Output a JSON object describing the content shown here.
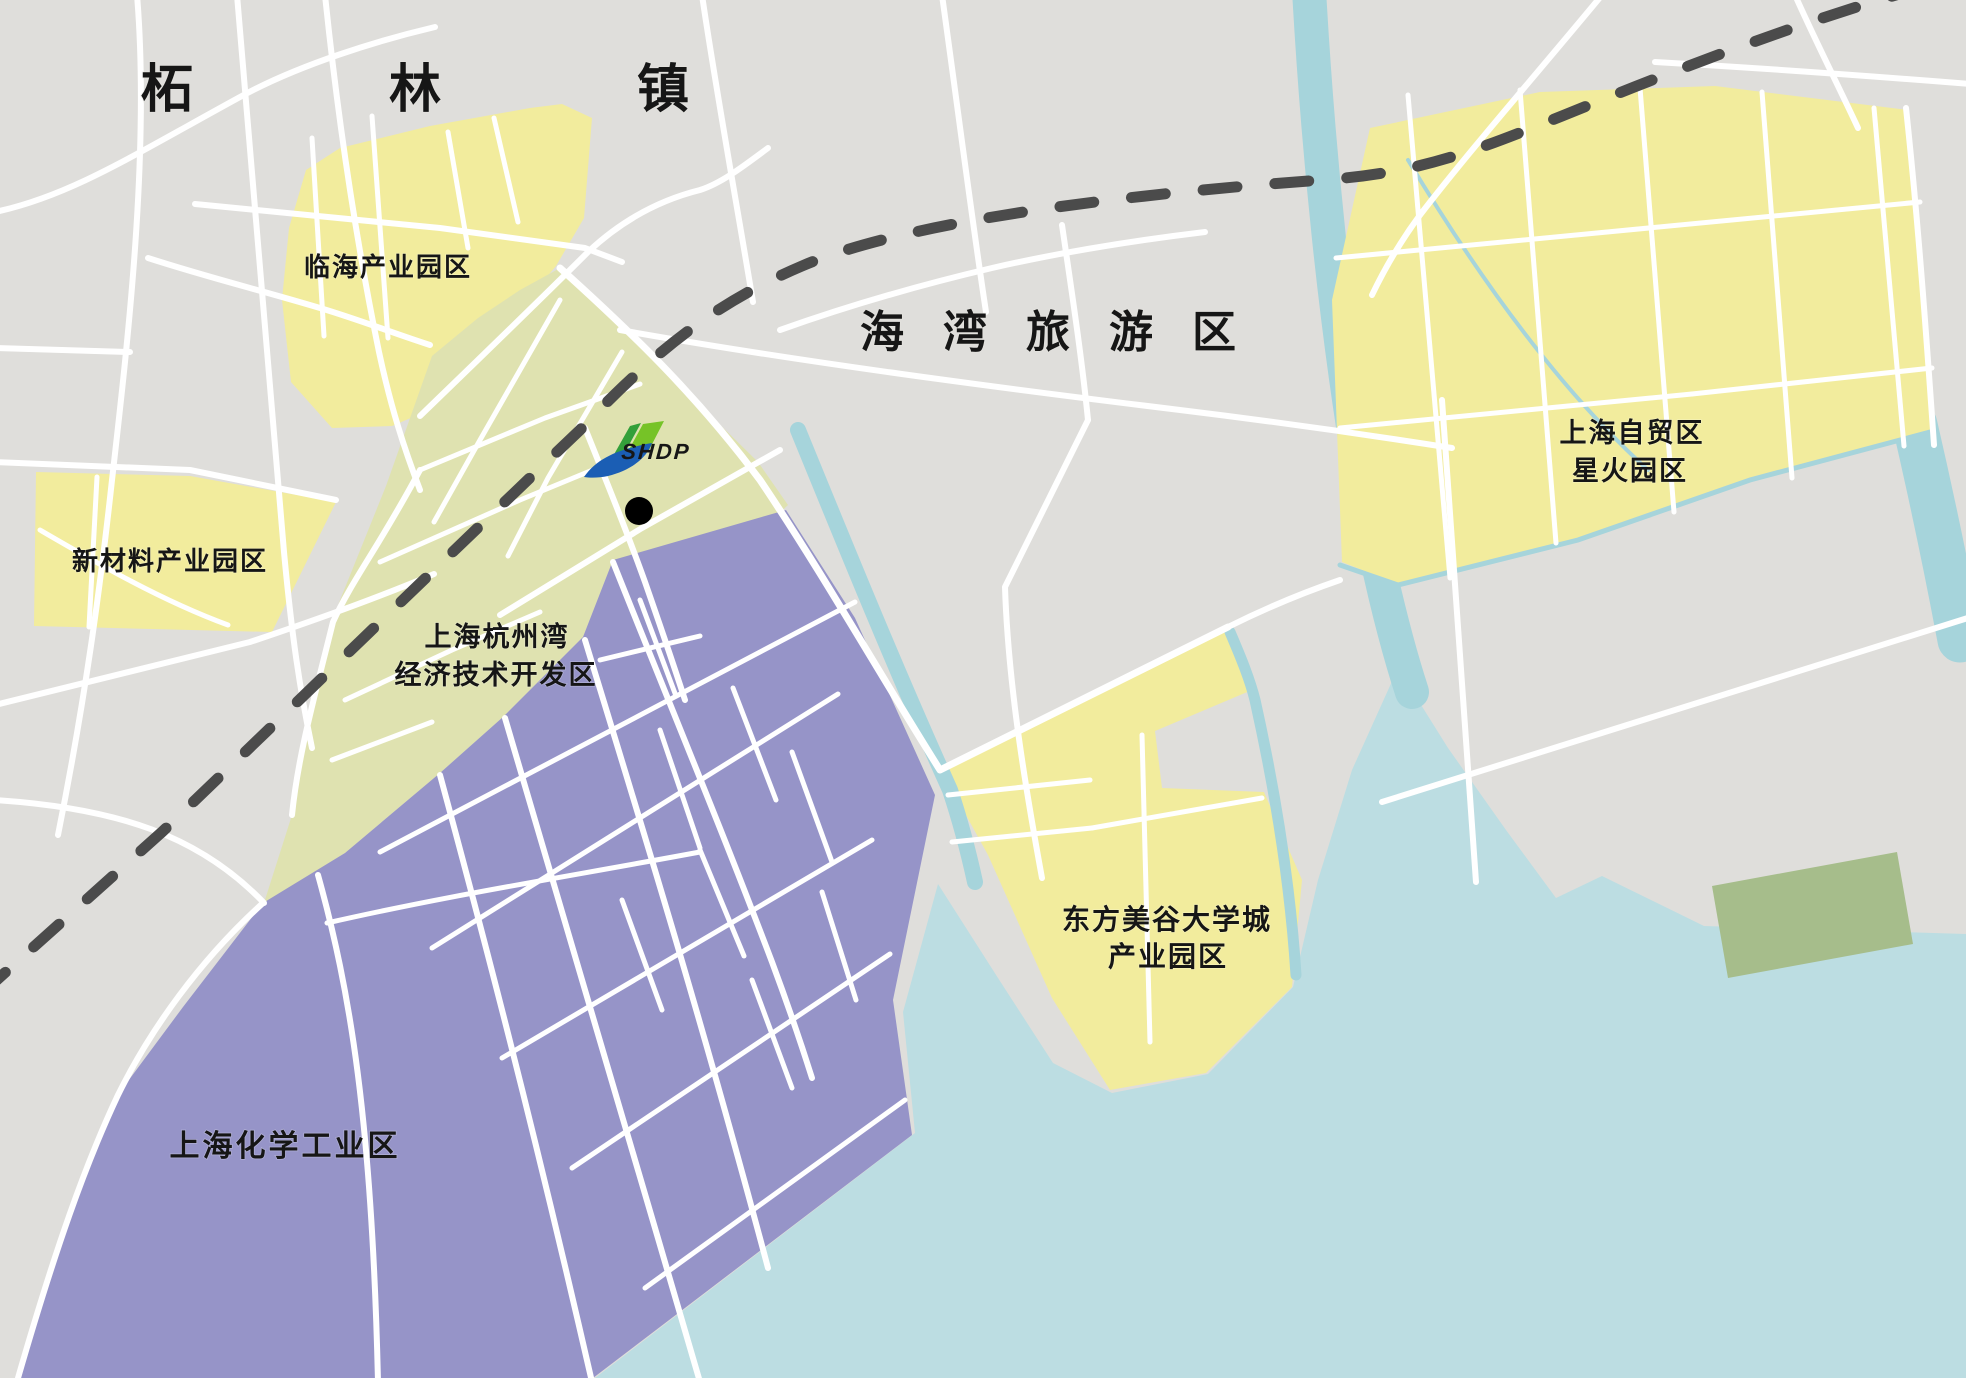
{
  "map": {
    "town_labels": {
      "zhelin": "柘林镇",
      "haiwan": "海湾旅游区"
    },
    "zones": [
      {
        "id": "linhai",
        "name": "临海产业园区"
      },
      {
        "id": "xincailiao",
        "name": "新材料产业园区"
      },
      {
        "id": "kaifaqu",
        "name_line1": "上海杭州湾",
        "name_line2": "经济技术开发区"
      },
      {
        "id": "huagong",
        "name": "上海化学工业区"
      },
      {
        "id": "meigu",
        "name_line1": "东方美谷大学城",
        "name_line2": "产业园区"
      },
      {
        "id": "zimao",
        "name_line1": "上海自贸区",
        "name_line2": "星火园区"
      }
    ],
    "marker": {
      "logo_text": "SHDP"
    },
    "colors": {
      "base": "#dfdedb",
      "road": "#ffffff",
      "water": "#bcdde2",
      "canal": "#a6d4db",
      "railway": "#4b4b4b",
      "zone_yellow": "#f2ec9d",
      "zone_green": "#dfe2b0",
      "zone_purple": "#9694c8",
      "olive": "#a6bd8b",
      "label": "#161616",
      "logo_green": "#76c327",
      "logo_green_dark": "#33a03a",
      "logo_blue": "#1b5eb4",
      "marker_black": "#000000"
    }
  }
}
